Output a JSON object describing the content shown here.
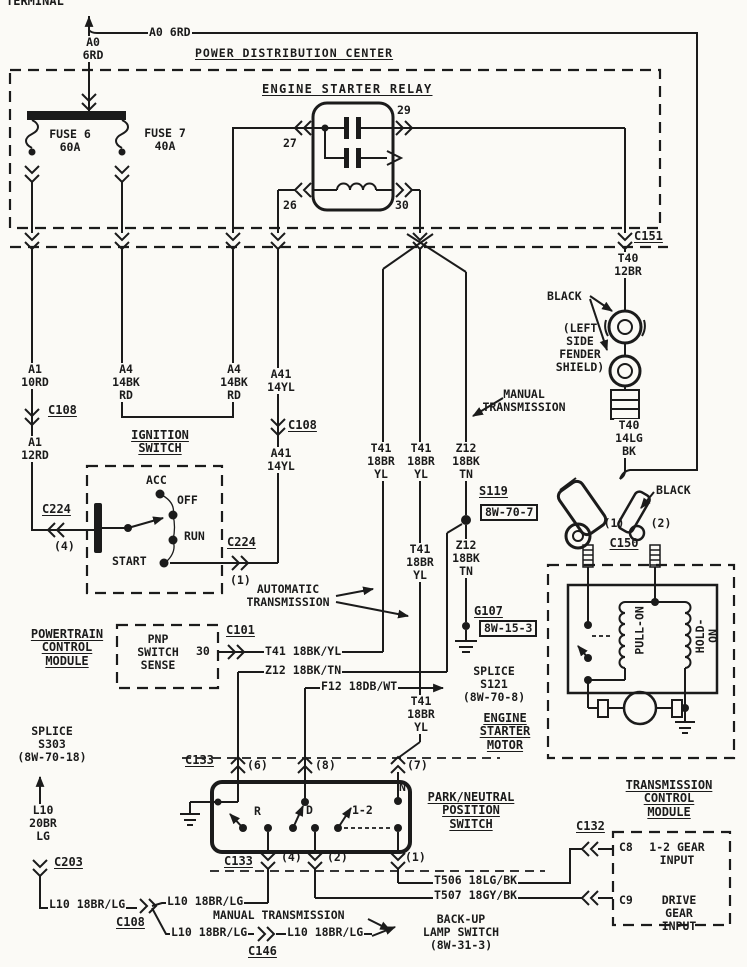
{
  "colors": {
    "ink": "#1b1b1b",
    "paper": "#fbfaf6"
  },
  "labels": [
    {
      "n": "terminal-label",
      "t": "TERMINAL",
      "x": 6,
      "y": -5,
      "fs": 12
    },
    {
      "n": "wire-a0-6rd-vertical",
      "t": "A0\n6RD",
      "x": 93,
      "y": 36,
      "c": 1,
      "bg": 1
    },
    {
      "n": "wire-a0-6rd-inline",
      "t": "A0 6RD",
      "x": 148,
      "y": 26,
      "bg": 1
    },
    {
      "n": "pdc-title",
      "t": "POWER DISTRIBUTION CENTER",
      "x": 195,
      "y": 47,
      "fs": 11.5,
      "u": 1,
      "ls": 1
    },
    {
      "n": "relay-title",
      "t": "ENGINE STARTER RELAY",
      "x": 262,
      "y": 83,
      "fs": 12,
      "u": 1,
      "ls": 1.3
    },
    {
      "n": "fuse6-label",
      "t": "FUSE 6\n60A",
      "x": 70,
      "y": 128,
      "c": 1
    },
    {
      "n": "fuse7-label",
      "t": "FUSE 7\n40A",
      "x": 165,
      "y": 127,
      "c": 1
    },
    {
      "n": "relay-pin-27",
      "t": "27",
      "x": 283,
      "y": 137
    },
    {
      "n": "relay-pin-29",
      "t": "29",
      "x": 397,
      "y": 104
    },
    {
      "n": "relay-pin-26",
      "t": "26",
      "x": 283,
      "y": 199
    },
    {
      "n": "relay-pin-30",
      "t": "30",
      "x": 395,
      "y": 199
    },
    {
      "n": "connector-c151",
      "t": "C151",
      "x": 633,
      "y": 230,
      "fs": 12,
      "u": 1,
      "bg": 1
    },
    {
      "n": "wire-t40-12br",
      "t": "T40\n12BR",
      "x": 628,
      "y": 252,
      "c": 1,
      "bg": 1
    },
    {
      "n": "black-label-1",
      "t": "BLACK",
      "x": 547,
      "y": 290
    },
    {
      "n": "fender-shield-note",
      "t": "(LEFT\nSIDE\nFENDER\nSHIELD)",
      "x": 580,
      "y": 322,
      "c": 1
    },
    {
      "n": "wire-t40-14lg-bk",
      "t": "T40\n14LG\nBK",
      "x": 629,
      "y": 419,
      "c": 1,
      "bg": 1
    },
    {
      "n": "black-label-2",
      "t": "BLACK",
      "x": 656,
      "y": 484
    },
    {
      "n": "c150-pin-1",
      "t": "(1)",
      "x": 614,
      "y": 517,
      "c": 1
    },
    {
      "n": "c150-pin-2",
      "t": "(2)",
      "x": 661,
      "y": 517,
      "c": 1
    },
    {
      "n": "connector-c150",
      "t": "C150",
      "x": 624,
      "y": 537,
      "c": 1,
      "fs": 12,
      "u": 1
    },
    {
      "n": "wire-a1-10rd",
      "t": "A1\n10RD",
      "x": 35,
      "y": 363,
      "c": 1,
      "bg": 1
    },
    {
      "n": "connector-c108-a",
      "t": "C108",
      "x": 48,
      "y": 404,
      "fs": 12,
      "u": 1
    },
    {
      "n": "wire-a1-12rd",
      "t": "A1\n12RD",
      "x": 35,
      "y": 436,
      "c": 1,
      "bg": 1
    },
    {
      "n": "wire-a4-14bkrd-1",
      "t": "A4\n14BK\nRD",
      "x": 126,
      "y": 363,
      "c": 1,
      "bg": 1
    },
    {
      "n": "wire-a4-14bkrd-2",
      "t": "A4\n14BK\nRD",
      "x": 234,
      "y": 363,
      "c": 1,
      "bg": 1
    },
    {
      "n": "wire-a41-14yl-1",
      "t": "A41\n14YL",
      "x": 281,
      "y": 368,
      "c": 1,
      "bg": 1
    },
    {
      "n": "connector-c108-b",
      "t": "C108",
      "x": 287,
      "y": 419,
      "fs": 12,
      "u": 1,
      "bg": 1
    },
    {
      "n": "wire-a41-14yl-2",
      "t": "A41\n14YL",
      "x": 281,
      "y": 447,
      "c": 1,
      "bg": 1
    },
    {
      "n": "ignition-switch-title",
      "t": "IGNITION\nSWITCH",
      "x": 160,
      "y": 429,
      "c": 1,
      "fs": 12,
      "u": 1
    },
    {
      "n": "ign-pos-acc",
      "t": "ACC",
      "x": 146,
      "y": 474
    },
    {
      "n": "ign-pos-off",
      "t": "OFF",
      "x": 177,
      "y": 494
    },
    {
      "n": "ign-pos-run",
      "t": "RUN",
      "x": 184,
      "y": 530
    },
    {
      "n": "ign-pos-start",
      "t": "START",
      "x": 112,
      "y": 555
    },
    {
      "n": "connector-c224-a",
      "t": "C224",
      "x": 42,
      "y": 503,
      "fs": 12,
      "u": 1
    },
    {
      "n": "c224-pin-4",
      "t": "(4)",
      "x": 54,
      "y": 540
    },
    {
      "n": "connector-c224-b",
      "t": "C224",
      "x": 227,
      "y": 536,
      "fs": 12,
      "u": 1
    },
    {
      "n": "c224-pin-1",
      "t": "(1)",
      "x": 230,
      "y": 574
    },
    {
      "n": "automatic-transmission-note",
      "t": "AUTOMATIC\nTRANSMISSION",
      "x": 288,
      "y": 583,
      "c": 1
    },
    {
      "n": "manual-transmission-note-1",
      "t": "MANUAL\nTRANSMISSION",
      "x": 524,
      "y": 388,
      "c": 1
    },
    {
      "n": "wire-t41-18bryl-1",
      "t": "T41\n18BR\nYL",
      "x": 381,
      "y": 442,
      "c": 1,
      "bg": 1
    },
    {
      "n": "wire-t41-18bryl-2",
      "t": "T41\n18BR\nYL",
      "x": 421,
      "y": 442,
      "c": 1,
      "bg": 1
    },
    {
      "n": "wire-z12-18bktn-1",
      "t": "Z12\n18BK\nTN",
      "x": 466,
      "y": 442,
      "c": 1,
      "bg": 1
    },
    {
      "n": "wire-t41-18bryl-3",
      "t": "T41\n18BR\nYL",
      "x": 420,
      "y": 543,
      "c": 1,
      "bg": 1
    },
    {
      "n": "splice-s119",
      "t": "S119",
      "x": 479,
      "y": 485,
      "fs": 12,
      "u": 1
    },
    {
      "n": "splice-s119-ref",
      "t": "8W-70-7",
      "x": 480,
      "y": 504,
      "box": 1
    },
    {
      "n": "wire-z12-18bktn-2",
      "t": "Z12\n18BK\nTN",
      "x": 466,
      "y": 539,
      "c": 1,
      "bg": 1
    },
    {
      "n": "ground-g107",
      "t": "G107",
      "x": 474,
      "y": 605,
      "fs": 12,
      "u": 1
    },
    {
      "n": "ground-g107-ref",
      "t": "8W-15-3",
      "x": 479,
      "y": 620,
      "box": 1
    },
    {
      "n": "pcm-title",
      "t": "POWERTRAIN\nCONTROL\nMODULE",
      "x": 67,
      "y": 628,
      "c": 1,
      "fs": 12,
      "u": 1
    },
    {
      "n": "pnp-switch-sense",
      "t": "PNP\nSWITCH\nSENSE",
      "x": 158,
      "y": 633,
      "c": 1
    },
    {
      "n": "pcm-pin-30",
      "t": "30",
      "x": 196,
      "y": 645
    },
    {
      "n": "connector-c101",
      "t": "C101",
      "x": 226,
      "y": 624,
      "fs": 12,
      "u": 1
    },
    {
      "n": "wire-t41-18bkyl",
      "t": "T41 18BK/YL",
      "x": 264,
      "y": 645,
      "bg": 1
    },
    {
      "n": "wire-z12-18bktn-h",
      "t": "Z12 18BK/TN",
      "x": 264,
      "y": 664,
      "bg": 1
    },
    {
      "n": "wire-f12-18dbwt",
      "t": "F12 18DB/WT",
      "x": 320,
      "y": 680,
      "bg": 1
    },
    {
      "n": "splice-s121-note",
      "t": "SPLICE\nS121\n(8W-70-8)",
      "x": 494,
      "y": 665,
      "c": 1
    },
    {
      "n": "wire-t41-18bryl-4",
      "t": "T41\n18BR\nYL",
      "x": 421,
      "y": 695,
      "c": 1,
      "bg": 1
    },
    {
      "n": "esm-title",
      "t": "ENGINE\nSTARTER\nMOTOR",
      "x": 505,
      "y": 712,
      "c": 1,
      "fs": 12,
      "u": 1
    },
    {
      "n": "splice-s303-note",
      "t": "SPLICE\nS303\n(8W-70-18)",
      "x": 52,
      "y": 725,
      "c": 1
    },
    {
      "n": "wire-l10-20br-lg",
      "t": "L10\n20BR\nLG",
      "x": 43,
      "y": 804,
      "c": 1,
      "bg": 1
    },
    {
      "n": "connector-c203",
      "t": "C203",
      "x": 54,
      "y": 856,
      "fs": 12,
      "u": 1
    },
    {
      "n": "connector-c133-a",
      "t": "C133",
      "x": 185,
      "y": 754,
      "fs": 12,
      "u": 1
    },
    {
      "n": "c133-pin-6",
      "t": "(6)",
      "x": 247,
      "y": 759
    },
    {
      "n": "c133-pin-8",
      "t": "(8)",
      "x": 315,
      "y": 759
    },
    {
      "n": "c133-pin-7",
      "t": "(7)",
      "x": 407,
      "y": 759
    },
    {
      "n": "pnp-title",
      "t": "PARK/NEUTRAL\nPOSITION\nSWITCH",
      "x": 471,
      "y": 791,
      "c": 1,
      "fs": 12,
      "u": 1
    },
    {
      "n": "pnp-pos-r",
      "t": "R",
      "x": 254,
      "y": 805
    },
    {
      "n": "pnp-pos-d",
      "t": "D",
      "x": 306,
      "y": 804
    },
    {
      "n": "pnp-pos-1-2",
      "t": "1-2",
      "x": 352,
      "y": 804
    },
    {
      "n": "pnp-pos-n",
      "t": "N",
      "x": 399,
      "y": 781
    },
    {
      "n": "connector-c133-b",
      "t": "C133",
      "x": 224,
      "y": 855,
      "fs": 12,
      "u": 1
    },
    {
      "n": "c133-pin-4",
      "t": "(4)",
      "x": 281,
      "y": 851
    },
    {
      "n": "c133-pin-2",
      "t": "(2)",
      "x": 327,
      "y": 851
    },
    {
      "n": "c133-pin-1",
      "t": "(1)",
      "x": 405,
      "y": 851
    },
    {
      "n": "wire-t506-18lgbk",
      "t": "T506 18LG/BK",
      "x": 433,
      "y": 874,
      "bg": 1
    },
    {
      "n": "wire-t507-18gybk",
      "t": "T507 18GY/BK",
      "x": 433,
      "y": 889,
      "bg": 1
    },
    {
      "n": "wire-l10-18brlg-1",
      "t": "L10 18BR/LG",
      "x": 48,
      "y": 898,
      "bg": 1
    },
    {
      "n": "connector-c108-c",
      "t": "C108",
      "x": 116,
      "y": 916,
      "fs": 12,
      "u": 1
    },
    {
      "n": "wire-l10-18brlg-2",
      "t": "L10 18BR/LG",
      "x": 166,
      "y": 895,
      "bg": 1
    },
    {
      "n": "wire-l10-18brlg-3",
      "t": "L10 18BR/LG",
      "x": 170,
      "y": 926,
      "bg": 1
    },
    {
      "n": "connector-c146",
      "t": "C146",
      "x": 248,
      "y": 945,
      "fs": 12,
      "u": 1
    },
    {
      "n": "wire-l10-18brlg-4",
      "t": "L10 18BR/LG",
      "x": 286,
      "y": 926,
      "bg": 1
    },
    {
      "n": "manual-transmission-note-2",
      "t": "MANUAL TRANSMISSION",
      "x": 212,
      "y": 909,
      "bg": 1
    },
    {
      "n": "backup-lamp-switch-note",
      "t": "BACK-UP\nLAMP SWITCH\n(8W-31-3)",
      "x": 461,
      "y": 913,
      "c": 1
    },
    {
      "n": "tcm-title",
      "t": "TRANSMISSION\nCONTROL\nMODULE",
      "x": 669,
      "y": 779,
      "c": 1,
      "fs": 12,
      "u": 1
    },
    {
      "n": "connector-c132",
      "t": "C132",
      "x": 576,
      "y": 820,
      "fs": 12,
      "u": 1
    },
    {
      "n": "tcm-c8",
      "t": "C8",
      "x": 619,
      "y": 841
    },
    {
      "n": "tcm-c8-input",
      "t": "1-2 GEAR\nINPUT",
      "x": 677,
      "y": 841,
      "c": 1
    },
    {
      "n": "tcm-c9",
      "t": "C9",
      "x": 619,
      "y": 894
    },
    {
      "n": "tcm-c9-input",
      "t": "DRIVE GEAR\nINPUT",
      "x": 679,
      "y": 894,
      "c": 1
    },
    {
      "n": "pull-on-coil-label",
      "t": "PULL-ON",
      "x": 640,
      "y": 624,
      "c": 1,
      "r": 1
    },
    {
      "n": "hold-on-coil-label",
      "t": "HOLD-ON",
      "x": 707,
      "y": 623,
      "c": 1,
      "r": 1
    }
  ]
}
